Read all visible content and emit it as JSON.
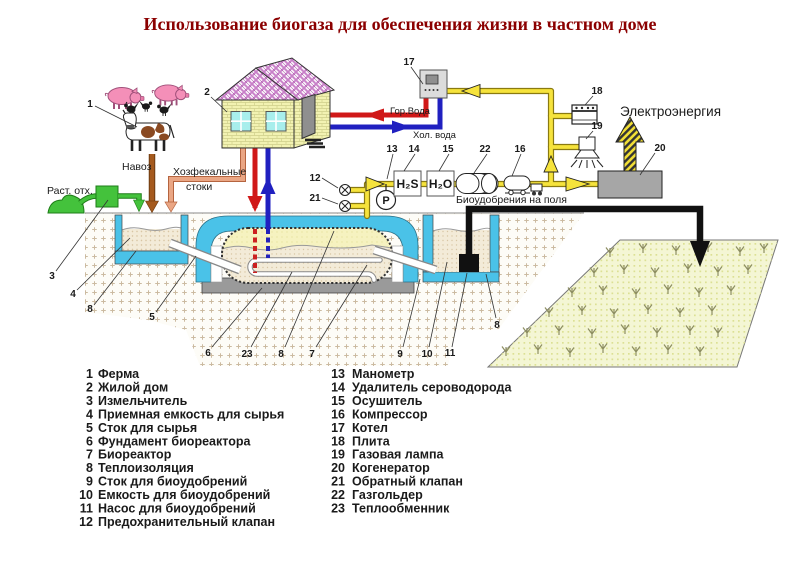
{
  "title": "Использование биогаза для обеспечения жизни в частном доме",
  "labels": {
    "plant_waste": "Раст. отх.",
    "manure": "Навоз",
    "sewage_line1": "Хозфекальные",
    "sewage_line2": "стоки",
    "hot_water": "Гор.Вода",
    "cold_water": "Хол. вода",
    "h2s_unit": "H₂S",
    "h2o_unit": "H₂O",
    "biofertilizer_to_fields": "Биоудобрения  на поля",
    "electricity": "Электроэнергия",
    "gauge_letter": "P"
  },
  "callouts": {
    "farm": "1",
    "house": "2",
    "shredder": "3",
    "intake_tank": "4",
    "insulation_left": "8",
    "feed_drain": "5",
    "foundation": "6",
    "heat_exchanger": "23",
    "insulation_center": "8",
    "bioreactor": "7",
    "fert_drain": "9",
    "fert_tank": "10",
    "pump": "11",
    "insulation_right": "8",
    "safety_valve": "12",
    "check_valve": "21",
    "manometer": "13",
    "h2s_remover": "14",
    "dryer": "15",
    "gasholder": "22",
    "compressor": "16",
    "boiler": "17",
    "stove": "18",
    "gas_lamp": "19",
    "cogenerator": "20"
  },
  "colors": {
    "accent_red": "#c43030",
    "text_black": "#1a1a1a",
    "title_red": "#8b0000"
  },
  "legend": {
    "left": [
      {
        "num": "1",
        "label": "Ферма",
        "color": "#1a1a1a"
      },
      {
        "num": "2",
        "label": "Жилой дом",
        "color": "#1a1a1a"
      },
      {
        "num": "3",
        "label": "Измельчитель",
        "color": "#1a1a1a"
      },
      {
        "num": "4",
        "label": "Приемная емкость для сырья",
        "color": "#1a1a1a"
      },
      {
        "num": "5",
        "label": "Сток для сырья",
        "color": "#c43030"
      },
      {
        "num": "6",
        "label": "Фундамент биореактора",
        "color": "#1a1a1a"
      },
      {
        "num": "7",
        "label": "Биореактор",
        "color": "#c43030"
      },
      {
        "num": "8",
        "label": "Теплоизоляция",
        "color": "#c43030"
      },
      {
        "num": "9",
        "label": "Сток для биоудобрений",
        "color": "#c43030"
      },
      {
        "num": "10",
        "label": "Емкость для биоудобрений",
        "color": "#1a1a1a"
      },
      {
        "num": "11",
        "label": "Насос для биоудобрений",
        "color": "#c43030"
      },
      {
        "num": "12",
        "label": "Предохранительный клапан",
        "color": "#c43030"
      }
    ],
    "right": [
      {
        "num": "13",
        "label": "Манометр",
        "color": "#c43030"
      },
      {
        "num": "14",
        "label": "Удалитель сероводорода",
        "color": "#c43030"
      },
      {
        "num": "15",
        "label": "Осушитель",
        "color": "#c43030"
      },
      {
        "num": "16",
        "label": "Компрессор",
        "color": "#c43030"
      },
      {
        "num": "17",
        "label": "Котел",
        "color": "#1a1a1a"
      },
      {
        "num": "18",
        "label": "Плита",
        "color": "#1a1a1a"
      },
      {
        "num": "19",
        "label": "Газовая лампа",
        "color": "#1a1a1a"
      },
      {
        "num": "20",
        "label": "Когенератор",
        "color": "#1a1a1a"
      },
      {
        "num": "21",
        "label": "Обратный клапан",
        "color": "#c43030"
      },
      {
        "num": "22",
        "label": "Газгольдер",
        "color": "#c43030"
      },
      {
        "num": "23",
        "label": "Теплообменник",
        "color": "#1a1a1a"
      }
    ]
  }
}
